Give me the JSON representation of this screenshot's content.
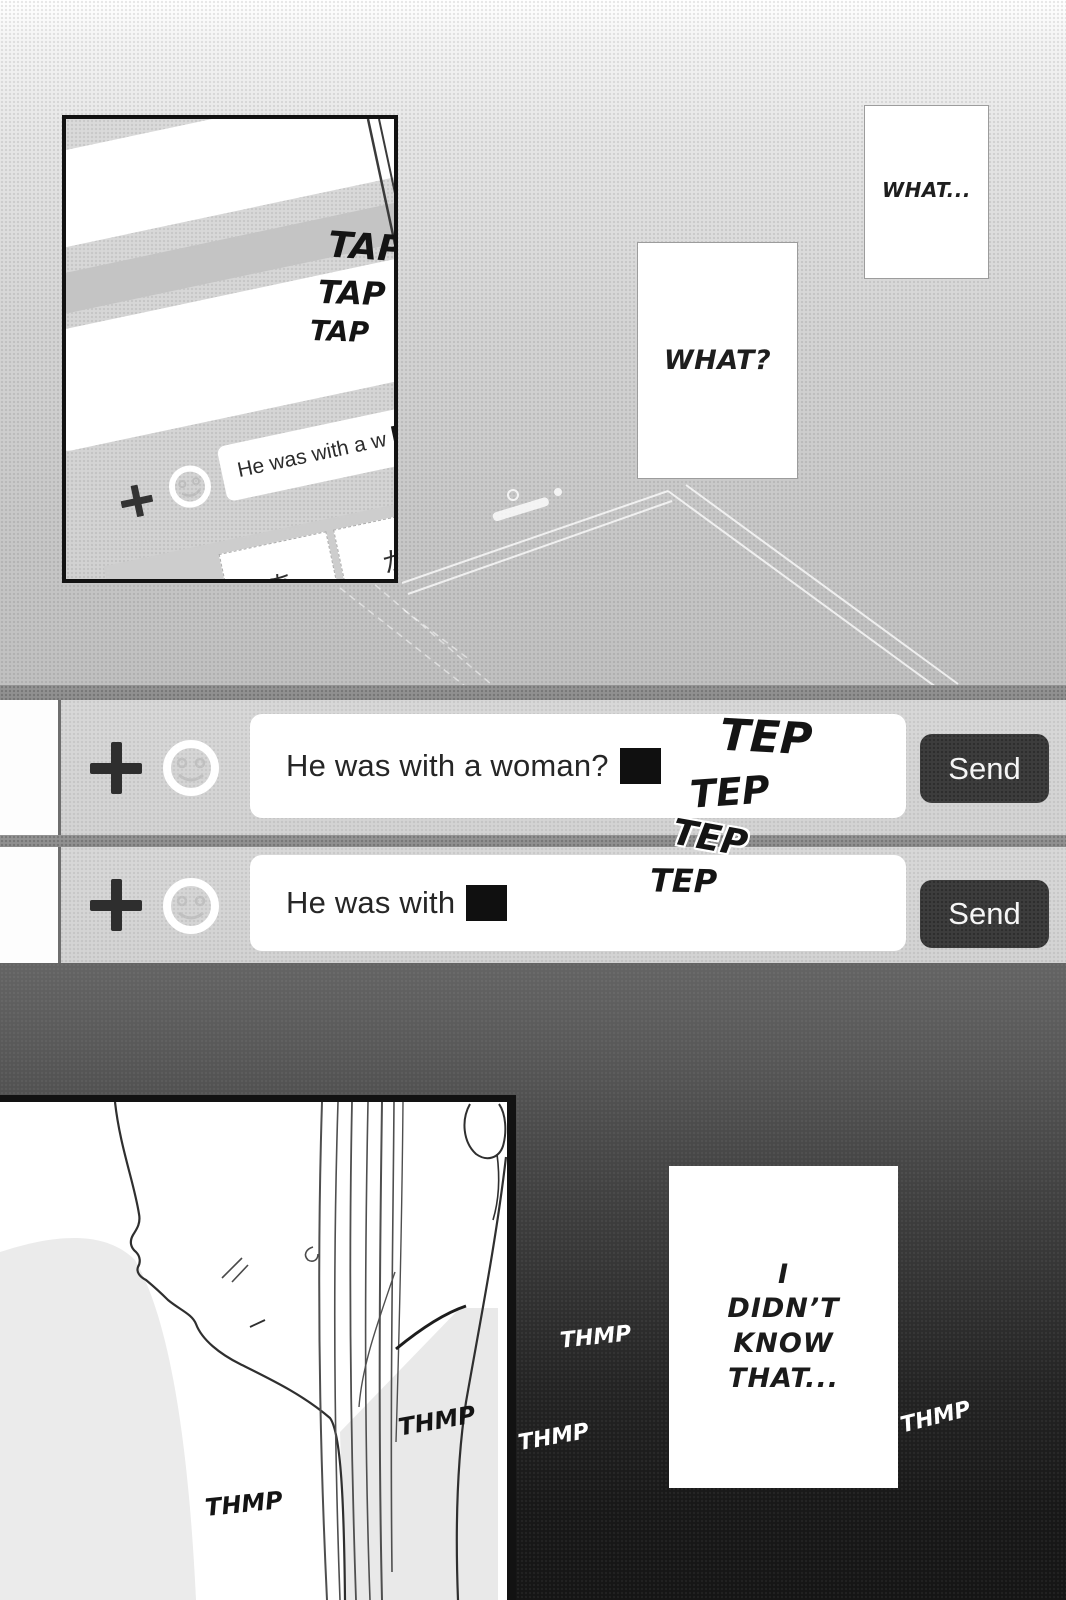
{
  "panel_phone": {
    "sfx_tap": [
      "TAP",
      "TAP",
      "TAP"
    ],
    "input_text": "He was with a w",
    "cursor": "|",
    "keyboard_keys": [
      "あ",
      "か",
      "さ",
      "は"
    ],
    "arrow_key": "→"
  },
  "bubbles": {
    "what_ellipsis": "WHAT...",
    "what_question": "WHAT?"
  },
  "chat_bar_1": {
    "message": "He was with a woman?",
    "cursor": "|",
    "send_label": "Send"
  },
  "chat_bar_2": {
    "message": "He was with",
    "cursor": "|",
    "send_label": "Send"
  },
  "sfx_tep": [
    "TEP",
    "TEP",
    "TEP",
    "TEP"
  ],
  "monologue": {
    "lines": [
      "I",
      "DIDN’T",
      "KNOW",
      "THAT..."
    ]
  },
  "sfx_thmp_dark": [
    "THMP",
    "THMP"
  ],
  "sfx_thmp_white": [
    "THMP",
    "THMP",
    "THMP"
  ],
  "icons": {
    "attach": "plus-icon",
    "emoji": "smiley-icon",
    "enter": "arrow-right-icon"
  },
  "colors": {
    "send_button": "#3d3d3d",
    "divider": "#8e8e8e",
    "dark_background": "#181818"
  }
}
